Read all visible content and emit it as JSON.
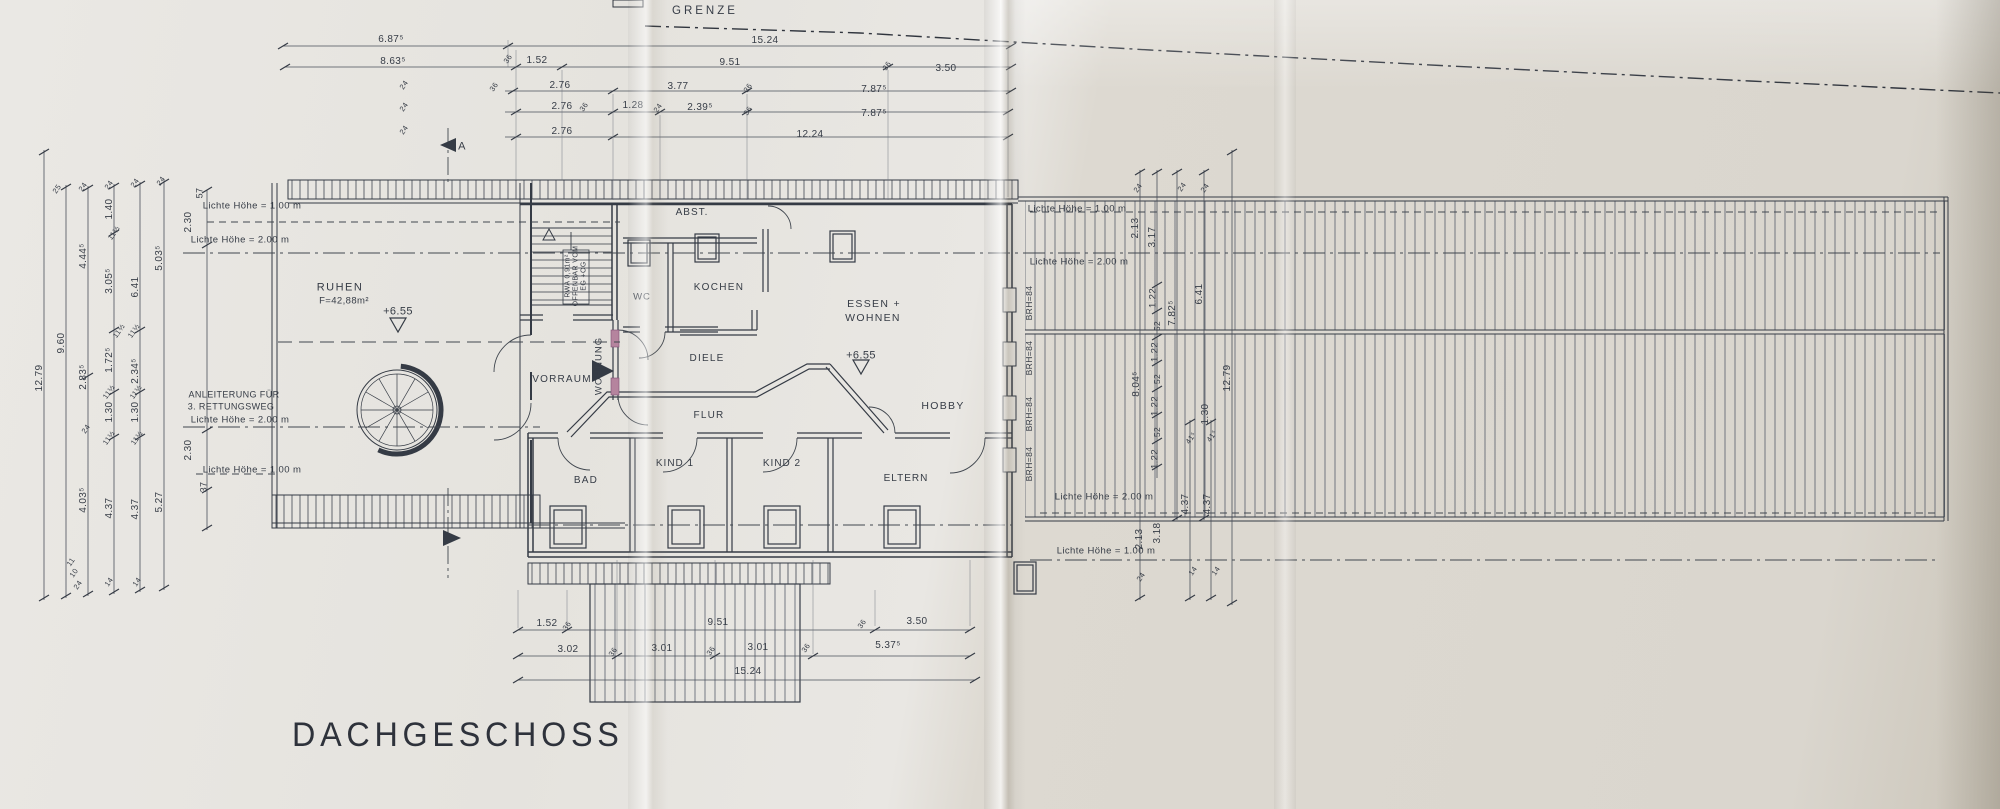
{
  "title": "DACHGESCHOSS",
  "boundary_label": "GRENZE",
  "colors": {
    "ink": "#353b45",
    "dim_line": "#4a505b",
    "hatch": "#565d6b",
    "door_accent": "#b5849e",
    "paper_left": "#e7e5e0",
    "paper_right": "#dbd7cf"
  },
  "stair_note": [
    "RWA 0,91m²",
    "OFFENBAR VOM",
    "EG +OG"
  ],
  "label_groups": {
    "rooms": [
      {
        "t": "RUHEN",
        "x": 340,
        "y": 288,
        "s": 11,
        "ls": 1.5
      },
      {
        "t": "F=42,88m²",
        "x": 344,
        "y": 301,
        "s": 9.5
      },
      {
        "t": "ABST.",
        "x": 692,
        "y": 213,
        "s": 10,
        "ls": 1
      },
      {
        "t": "WC",
        "x": 642,
        "y": 297,
        "s": 9.5,
        "ls": 1
      },
      {
        "t": "KOCHEN",
        "x": 719,
        "y": 288,
        "s": 10,
        "ls": 1.3
      },
      {
        "t": "ESSEN +",
        "x": 874,
        "y": 304,
        "s": 10.5,
        "ls": 1.3
      },
      {
        "t": "WOHNEN",
        "x": 873,
        "y": 318,
        "s": 10.5,
        "ls": 1.3
      },
      {
        "t": "VORRAUM",
        "x": 562,
        "y": 380,
        "s": 10,
        "ls": 1.2
      },
      {
        "t": "DIELE",
        "x": 707,
        "y": 359,
        "s": 10,
        "ls": 1.2
      },
      {
        "t": "FLUR",
        "x": 709,
        "y": 416,
        "s": 10,
        "ls": 1.2
      },
      {
        "t": "HOBBY",
        "x": 943,
        "y": 406,
        "s": 10.5,
        "ls": 1.3
      },
      {
        "t": "BAD",
        "x": 586,
        "y": 481,
        "s": 10,
        "ls": 1.2
      },
      {
        "t": "KIND 1",
        "x": 675,
        "y": 464,
        "s": 10,
        "ls": 1
      },
      {
        "t": "KIND 2",
        "x": 782,
        "y": 464,
        "s": 10,
        "ls": 1
      },
      {
        "t": "ELTERN",
        "x": 906,
        "y": 479,
        "s": 10,
        "ls": 1
      },
      {
        "t": "WOHNUNG",
        "x": 599,
        "y": 366,
        "s": 9.5,
        "r": -90,
        "ls": 1
      }
    ],
    "height_labels": [
      {
        "t": "Lichte Höhe = 1.00 m",
        "x": 252,
        "y": 206,
        "s": 9.5
      },
      {
        "t": "Lichte Höhe = 2.00 m",
        "x": 240,
        "y": 240,
        "s": 9.5
      },
      {
        "t": "Lichte Höhe = 2.00 m",
        "x": 240,
        "y": 420,
        "s": 9.5
      },
      {
        "t": "Lichte Höhe = 1.00 m",
        "x": 252,
        "y": 470,
        "s": 9.5
      },
      {
        "t": "Lichte Höhe = 1.00 m",
        "x": 1077,
        "y": 209,
        "s": 9.5
      },
      {
        "t": "Lichte Höhe = 2.00 m",
        "x": 1079,
        "y": 262,
        "s": 9.5
      },
      {
        "t": "Lichte Höhe = 2.00 m",
        "x": 1104,
        "y": 497,
        "s": 9.5
      },
      {
        "t": "Lichte Höhe = 1.00 m",
        "x": 1106,
        "y": 551,
        "s": 9.5
      }
    ],
    "annotations": [
      {
        "t": "ANLEITERUNG FÜR",
        "x": 234,
        "y": 395,
        "s": 9
      },
      {
        "t": "3. RETTUNGSWEG",
        "x": 231,
        "y": 407,
        "s": 9
      }
    ],
    "elevations": [
      {
        "t": "+6.55",
        "x": 398,
        "y": 312,
        "s": 11
      },
      {
        "t": "+6.55",
        "x": 861,
        "y": 356,
        "s": 11
      }
    ],
    "dims_top": [
      {
        "t": "6.87⁵",
        "x": 391,
        "y": 40,
        "s": 10
      },
      {
        "t": "15.24",
        "x": 765,
        "y": 41,
        "s": 10
      },
      {
        "t": "8.63⁵",
        "x": 393,
        "y": 62,
        "s": 10
      },
      {
        "t": "1.52",
        "x": 537,
        "y": 61,
        "s": 10
      },
      {
        "t": "9.51",
        "x": 730,
        "y": 63,
        "s": 10
      },
      {
        "t": "3.50",
        "x": 946,
        "y": 69,
        "s": 10
      },
      {
        "t": "2.76",
        "x": 560,
        "y": 86,
        "s": 10
      },
      {
        "t": "3.77",
        "x": 678,
        "y": 87,
        "s": 10
      },
      {
        "t": "7.87⁵",
        "x": 874,
        "y": 90,
        "s": 10
      },
      {
        "t": "2.76",
        "x": 562,
        "y": 107,
        "s": 10
      },
      {
        "t": "1.28",
        "x": 633,
        "y": 106,
        "s": 10
      },
      {
        "t": "2.39⁵",
        "x": 700,
        "y": 108,
        "s": 10
      },
      {
        "t": "7.87⁵",
        "x": 874,
        "y": 114,
        "s": 10
      },
      {
        "t": "2.76",
        "x": 562,
        "y": 132,
        "s": 10
      },
      {
        "t": "12.24",
        "x": 810,
        "y": 135,
        "s": 10
      }
    ],
    "dims_bottom": [
      {
        "t": "1.52",
        "x": 547,
        "y": 624,
        "s": 10
      },
      {
        "t": "9.51",
        "x": 718,
        "y": 623,
        "s": 10
      },
      {
        "t": "3.50",
        "x": 917,
        "y": 622,
        "s": 10
      },
      {
        "t": "3.02",
        "x": 568,
        "y": 650,
        "s": 10
      },
      {
        "t": "3.01",
        "x": 662,
        "y": 649,
        "s": 10
      },
      {
        "t": "3.01",
        "x": 758,
        "y": 648,
        "s": 10
      },
      {
        "t": "5.37⁵",
        "x": 888,
        "y": 646,
        "s": 10
      },
      {
        "t": "15.24",
        "x": 748,
        "y": 672,
        "s": 10
      }
    ],
    "dims_left": [
      {
        "t": "12.79",
        "x": 40,
        "y": 378,
        "s": 10,
        "r": -90
      },
      {
        "t": "9.60",
        "x": 62,
        "y": 343,
        "s": 10,
        "r": -90
      },
      {
        "t": "4.44⁵",
        "x": 84,
        "y": 256,
        "s": 10,
        "r": -90
      },
      {
        "t": "2.83⁵",
        "x": 84,
        "y": 377,
        "s": 10,
        "r": -90
      },
      {
        "t": "4.03⁵",
        "x": 84,
        "y": 500,
        "s": 10,
        "r": -90
      },
      {
        "t": "1.40",
        "x": 110,
        "y": 209,
        "s": 10,
        "r": -90
      },
      {
        "t": "3.05⁵",
        "x": 110,
        "y": 281,
        "s": 10,
        "r": -90
      },
      {
        "t": "1.72⁵",
        "x": 110,
        "y": 360,
        "s": 10,
        "r": -90
      },
      {
        "t": "1.30",
        "x": 110,
        "y": 412,
        "s": 10,
        "r": -90
      },
      {
        "t": "4.37",
        "x": 110,
        "y": 508,
        "s": 10,
        "r": -90
      },
      {
        "t": "6.41",
        "x": 136,
        "y": 287,
        "s": 10,
        "r": -90
      },
      {
        "t": "2.34⁵",
        "x": 136,
        "y": 371,
        "s": 10,
        "r": -90
      },
      {
        "t": "1.30",
        "x": 136,
        "y": 412,
        "s": 10,
        "r": -90
      },
      {
        "t": "4.37",
        "x": 136,
        "y": 509,
        "s": 10,
        "r": -90
      },
      {
        "t": "5.03⁵",
        "x": 160,
        "y": 258,
        "s": 10,
        "r": -90
      },
      {
        "t": "5.27",
        "x": 160,
        "y": 502,
        "s": 10,
        "r": -90
      }
    ],
    "dims_right": [
      {
        "t": "2.13",
        "x": 1136,
        "y": 228,
        "s": 10,
        "r": -90
      },
      {
        "t": "3.17",
        "x": 1153,
        "y": 237,
        "s": 10,
        "r": -90
      },
      {
        "t": "1.22",
        "x": 1153,
        "y": 298,
        "s": 9.5,
        "r": -90
      },
      {
        "t": "52",
        "x": 1157,
        "y": 326,
        "s": 8.5,
        "r": -90
      },
      {
        "t": "1.22",
        "x": 1155,
        "y": 352,
        "s": 9.5,
        "r": -90
      },
      {
        "t": "52",
        "x": 1157,
        "y": 379,
        "s": 8.5,
        "r": -90
      },
      {
        "t": "1.22",
        "x": 1155,
        "y": 406,
        "s": 9.5,
        "r": -90
      },
      {
        "t": "52",
        "x": 1157,
        "y": 432,
        "s": 8.5,
        "r": -90
      },
      {
        "t": "1.22",
        "x": 1155,
        "y": 459,
        "s": 9.5,
        "r": -90
      },
      {
        "t": "8.04⁵",
        "x": 1137,
        "y": 384,
        "s": 10,
        "r": -90
      },
      {
        "t": "7.82⁵",
        "x": 1173,
        "y": 313,
        "s": 10,
        "r": -90
      },
      {
        "t": "6.41",
        "x": 1200,
        "y": 294,
        "s": 10,
        "r": -90
      },
      {
        "t": "12.79",
        "x": 1228,
        "y": 378,
        "s": 10,
        "r": -90
      },
      {
        "t": "1.30",
        "x": 1206,
        "y": 414,
        "s": 10,
        "r": -90
      },
      {
        "t": "2.13",
        "x": 1140,
        "y": 539,
        "s": 10,
        "r": -90
      },
      {
        "t": "3.18",
        "x": 1158,
        "y": 533,
        "s": 10,
        "r": -90
      },
      {
        "t": "4.37",
        "x": 1186,
        "y": 504,
        "s": 10,
        "r": -90
      },
      {
        "t": "4.37",
        "x": 1208,
        "y": 504,
        "s": 10,
        "r": -90
      }
    ],
    "dims_inner": [
      {
        "t": "57",
        "x": 200,
        "y": 193,
        "s": 9,
        "r": -90
      },
      {
        "t": "2.30",
        "x": 189,
        "y": 222,
        "s": 10,
        "r": -90
      },
      {
        "t": "2.30",
        "x": 189,
        "y": 450,
        "s": 10,
        "r": -90
      },
      {
        "t": "37",
        "x": 204,
        "y": 487,
        "s": 9,
        "r": -90
      }
    ],
    "tick_labels": [
      {
        "t": "36",
        "x": 508,
        "y": 59,
        "s": 7.5,
        "r": -55
      },
      {
        "t": "24",
        "x": 404,
        "y": 85,
        "s": 7.5,
        "r": -55
      },
      {
        "t": "36",
        "x": 494,
        "y": 87,
        "s": 7.5,
        "r": -55
      },
      {
        "t": "24",
        "x": 404,
        "y": 107,
        "s": 7.5,
        "r": -55
      },
      {
        "t": "36",
        "x": 584,
        "y": 107,
        "s": 7.5,
        "r": -55
      },
      {
        "t": "24",
        "x": 658,
        "y": 108,
        "s": 7.5,
        "r": -55
      },
      {
        "t": "36",
        "x": 748,
        "y": 88,
        "s": 7.5,
        "r": -55
      },
      {
        "t": "36",
        "x": 748,
        "y": 111,
        "s": 7.5,
        "r": -55
      },
      {
        "t": "36",
        "x": 887,
        "y": 66,
        "s": 7.5,
        "r": -55
      },
      {
        "t": "24",
        "x": 404,
        "y": 130,
        "s": 7.5,
        "r": -55
      },
      {
        "t": "25",
        "x": 57,
        "y": 189,
        "s": 7.5,
        "r": -55
      },
      {
        "t": "24",
        "x": 83,
        "y": 187,
        "s": 7.5,
        "r": -55
      },
      {
        "t": "24",
        "x": 109,
        "y": 185,
        "s": 7.5,
        "r": -55
      },
      {
        "t": "24",
        "x": 135,
        "y": 183,
        "s": 7.5,
        "r": -55
      },
      {
        "t": "24",
        "x": 161,
        "y": 181,
        "s": 7.5,
        "r": -55
      },
      {
        "t": "11½",
        "x": 114,
        "y": 233,
        "s": 7.5,
        "r": -55
      },
      {
        "t": "11½",
        "x": 119,
        "y": 331,
        "s": 7.5,
        "r": -55
      },
      {
        "t": "11½",
        "x": 134,
        "y": 331,
        "s": 7.5,
        "r": -55
      },
      {
        "t": "11½",
        "x": 109,
        "y": 392,
        "s": 7.5,
        "r": -55
      },
      {
        "t": "11½",
        "x": 136,
        "y": 392,
        "s": 7.5,
        "r": -55
      },
      {
        "t": "24",
        "x": 86,
        "y": 429,
        "s": 7.5,
        "r": -55
      },
      {
        "t": "11½",
        "x": 109,
        "y": 438,
        "s": 7.5,
        "r": -55
      },
      {
        "t": "11½",
        "x": 137,
        "y": 438,
        "s": 7.5,
        "r": -55
      },
      {
        "t": "11",
        "x": 71,
        "y": 562,
        "s": 7.5,
        "r": -55
      },
      {
        "t": "10",
        "x": 74,
        "y": 573,
        "s": 7.5,
        "r": -55
      },
      {
        "t": "24",
        "x": 78,
        "y": 585,
        "s": 7.5,
        "r": -55
      },
      {
        "t": "14",
        "x": 109,
        "y": 582,
        "s": 7.5,
        "r": -55
      },
      {
        "t": "14",
        "x": 137,
        "y": 582,
        "s": 7.5,
        "r": -55
      },
      {
        "t": "24",
        "x": 1138,
        "y": 188,
        "s": 7.5,
        "r": -55
      },
      {
        "t": "24",
        "x": 1182,
        "y": 187,
        "s": 7.5,
        "r": -55
      },
      {
        "t": "24",
        "x": 1205,
        "y": 188,
        "s": 7.5,
        "r": -55
      },
      {
        "t": "41⁵",
        "x": 1191,
        "y": 438,
        "s": 7.5,
        "r": -55
      },
      {
        "t": "41⁵",
        "x": 1212,
        "y": 436,
        "s": 7.5,
        "r": -55
      },
      {
        "t": "24",
        "x": 1141,
        "y": 577,
        "s": 7.5,
        "r": -55
      },
      {
        "t": "14",
        "x": 1193,
        "y": 571,
        "s": 7.5,
        "r": -55
      },
      {
        "t": "14",
        "x": 1216,
        "y": 571,
        "s": 7.5,
        "r": -55
      },
      {
        "t": "36",
        "x": 567,
        "y": 626,
        "s": 7.5,
        "r": -55
      },
      {
        "t": "36",
        "x": 613,
        "y": 652,
        "s": 7.5,
        "r": -55
      },
      {
        "t": "36",
        "x": 711,
        "y": 651,
        "s": 7.5,
        "r": -55
      },
      {
        "t": "36",
        "x": 806,
        "y": 648,
        "s": 7.5,
        "r": -55
      },
      {
        "t": "36",
        "x": 862,
        "y": 624,
        "s": 7.5,
        "r": -55
      }
    ],
    "brh_labels": [
      {
        "t": "BRH=84",
        "x": 1029,
        "y": 303,
        "s": 8.5,
        "r": -90
      },
      {
        "t": "BRH=84",
        "x": 1029,
        "y": 358,
        "s": 8.5,
        "r": -90
      },
      {
        "t": "BRH=84",
        "x": 1029,
        "y": 414,
        "s": 8.5,
        "r": -90
      },
      {
        "t": "BRH=84",
        "x": 1029,
        "y": 464,
        "s": 8.5,
        "r": -90
      }
    ],
    "section_labels": [
      {
        "t": "A",
        "x": 462,
        "y": 147,
        "s": 11
      }
    ],
    "stair_note_labels": [
      {
        "t": "RWA 0,91m²",
        "x": 568,
        "y": 276,
        "s": 7,
        "r": -90
      },
      {
        "t": "OFFENBAR VOM",
        "x": 576,
        "y": 276,
        "s": 7,
        "r": -90
      },
      {
        "t": "EG +OG",
        "x": 584,
        "y": 276,
        "s": 7,
        "r": -90
      }
    ]
  }
}
